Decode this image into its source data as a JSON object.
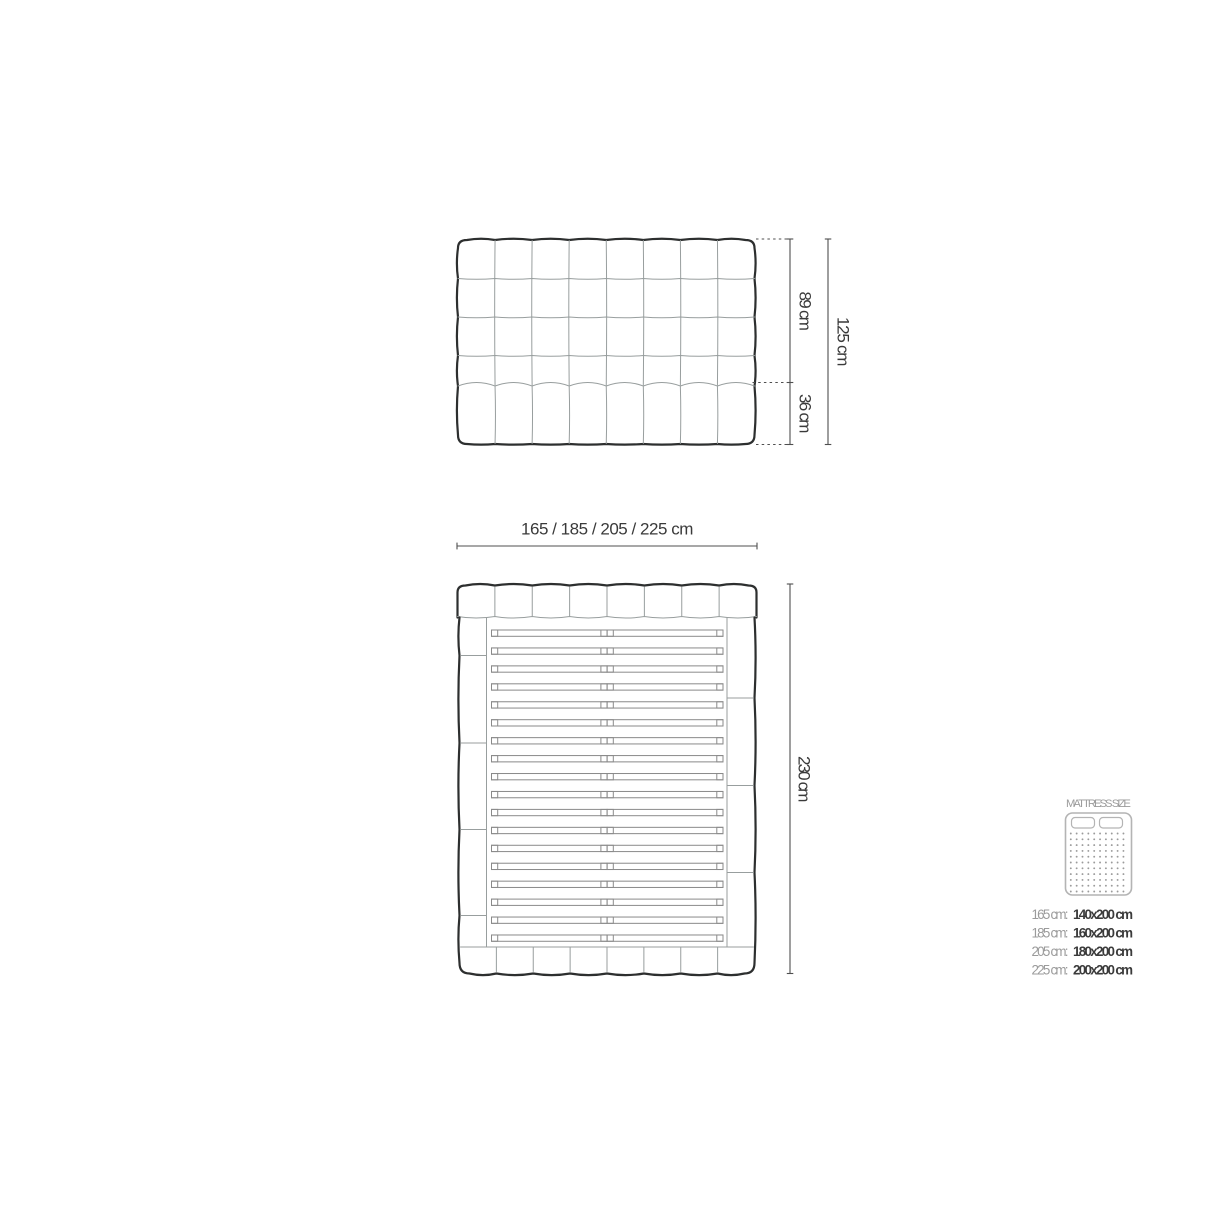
{
  "diagram": {
    "front_view": {
      "label": "headboard front view",
      "columns": 8,
      "tufted_rows": 4,
      "bottom_panel_cells": 8,
      "dimensions": {
        "upper_height_label": "89 cm",
        "lower_height_label": "36 cm",
        "total_height_label": "125 cm"
      }
    },
    "top_view": {
      "label": "bed top view",
      "width_options_label": "165 / 185 / 205 / 225 cm",
      "length_label": "230 cm",
      "headboard_cells": 8,
      "footboard_cells": 8,
      "slat_count": 18,
      "left_rail_segments": 5,
      "right_rail_segments": 4
    }
  },
  "mattress_panel": {
    "title": "MATTRESS SIZE",
    "icon": "mattress-top-icon",
    "sizes": [
      {
        "bed_width": "165 cm:",
        "mattress": "140x200 cm"
      },
      {
        "bed_width": "185 cm:",
        "mattress": "160x200 cm"
      },
      {
        "bed_width": "205 cm:",
        "mattress": "180x200 cm"
      },
      {
        "bed_width": "225 cm:",
        "mattress": "200x200 cm"
      }
    ]
  },
  "colors": {
    "background": "#ffffff",
    "outline_strong": "#2d2f2f",
    "outline_light": "#989e9e",
    "dimension_line": "#4f4f4f",
    "label_text": "#3a3a3a",
    "muted_text": "#9b9b9b",
    "strong_text": "#3b3b3b",
    "icon_stroke": "#b4b4b4"
  }
}
